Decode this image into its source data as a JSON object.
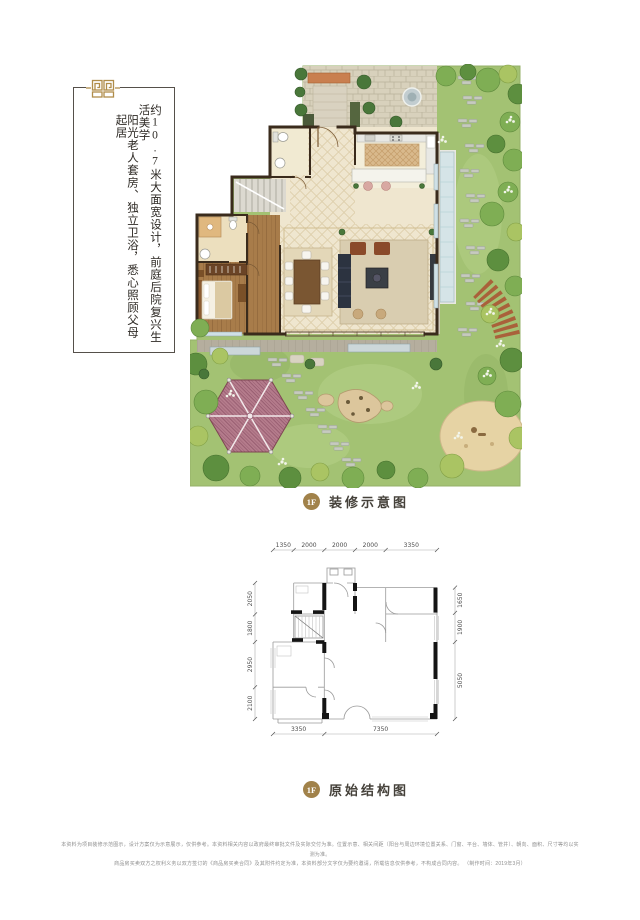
{
  "intro": {
    "line1": "约10.7米大面宽设计，前庭后院复兴生活美学",
    "line2": "阳光老人套房、独立卫浴，悉心照顾父母起居"
  },
  "decorated_plan": {
    "badge": "1F",
    "caption": "装修示意图"
  },
  "structural_plan": {
    "badge": "1F",
    "caption": "原始结构图",
    "dims_top": [
      "1350",
      "2000",
      "2000",
      "2000",
      "3350"
    ],
    "dims_left": [
      "2050",
      "1800",
      "2950",
      "2100"
    ],
    "dims_right": [
      "1650",
      "1900",
      "5050"
    ],
    "dims_bottom": [
      "3350",
      "7350"
    ]
  },
  "footer": {
    "line1": "本资料为项目装修示范图示，设计方案仅为示意展示，仅供参考。本资料相关内容以政府最终审批文件及实际交付为准。位置示意、相关间距（阳台与周边环境位置关系、门窗、平台、墙体、管井）、朝向、面积、尺寸等均以实测为准。",
    "line2": "商品房买卖双方之权利义务以双方签订的《商品房买卖合同》及其附件约定为准，本资料部分文字仅为要约邀请，所载信息仅供参考，不构成合同内容。 （制作时间：2019年3月）"
  },
  "colors": {
    "gold": "#a1824a",
    "ink": "#2e2a25",
    "lawn": "#a3c273"
  }
}
